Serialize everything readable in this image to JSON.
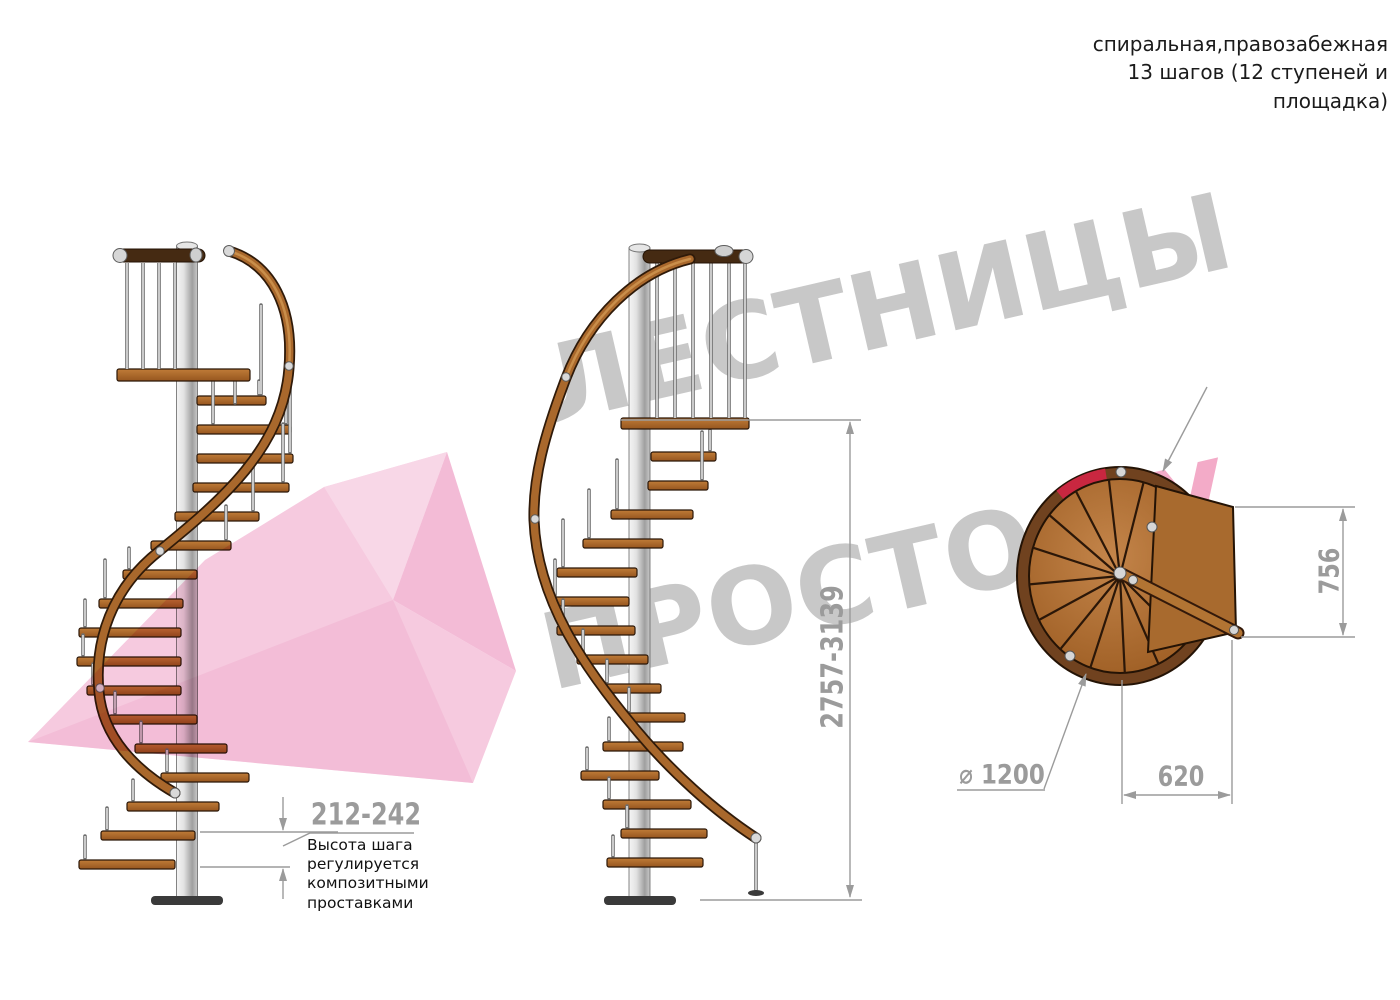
{
  "header": {
    "title": "спиральная,правозабежная\n13 шагов (12 ступеней и\nплощадка)"
  },
  "watermark": {
    "line1": "ЛЕСТНИЦЫ",
    "line2_gray": "ПРОСТО.",
    "line2_pink": "РУ"
  },
  "dimensions": {
    "step_height": "212-242",
    "note": "Высота шага\nрегулируется\nкомпозитными\nпроставками",
    "total_height": "2757-3139",
    "platform_depth": "756",
    "platform_width": "620",
    "diameter": "⌀ 1200"
  },
  "colors": {
    "wood": "#a9682c",
    "wood_dark": "#7a451c",
    "rail_dark": "#452a12",
    "steel": "#d9d9d9",
    "dimension_gray": "#9b9b9b",
    "watermark_gray": "#c8c8c8",
    "watermark_pink": "#f3abc8",
    "arrow_pink": "#f6cadf",
    "accent_red": "#c92740",
    "text_black": "#1b1b1b"
  }
}
